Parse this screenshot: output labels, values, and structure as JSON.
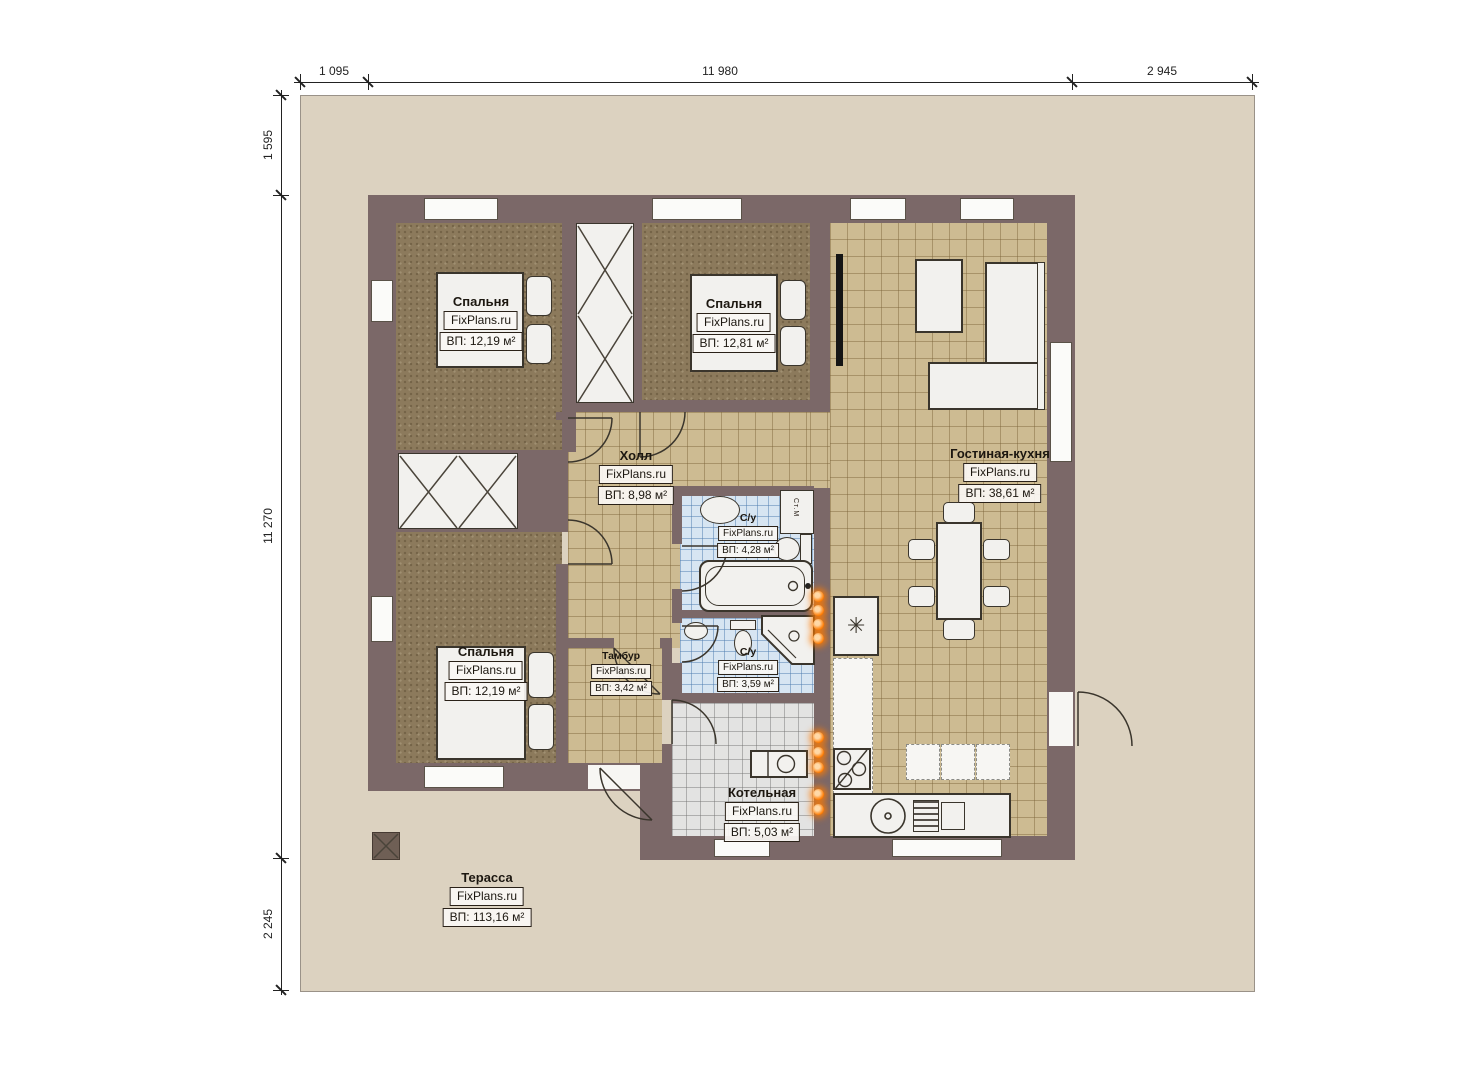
{
  "watermark": "FixPlans.ru",
  "dimensions": {
    "top": [
      "1 095",
      "11 980",
      "2 945"
    ],
    "left": [
      "1 595",
      "11 270",
      "2 245"
    ]
  },
  "rooms": [
    {
      "id": "bedroom-1",
      "name": "Спальня",
      "area": "ВП: 12,19 м²"
    },
    {
      "id": "bedroom-2",
      "name": "Спальня",
      "area": "ВП: 12,81 м²"
    },
    {
      "id": "living-kitchen",
      "name": "Гостиная-кухня",
      "area": "ВП: 38,61 м²"
    },
    {
      "id": "hall",
      "name": "Холл",
      "area": "ВП: 8,98 м²"
    },
    {
      "id": "bathroom-1",
      "name": "С/у",
      "area": "ВП: 4,28 м²"
    },
    {
      "id": "bathroom-2",
      "name": "С/у",
      "area": "ВП: 3,59 м²"
    },
    {
      "id": "vestibule",
      "name": "Тамбур",
      "area": "ВП: 3,42 м²"
    },
    {
      "id": "boiler-room",
      "name": "Котельная",
      "area": "ВП: 5,03 м²"
    },
    {
      "id": "bedroom-3",
      "name": "Спальня",
      "area": "ВП: 12,19 м²"
    },
    {
      "id": "terrace",
      "name": "Терасса",
      "area": "ВП: 113,16 м²"
    }
  ],
  "annotations": {
    "washing_machine": "Ст.М",
    "fridge_symbol": "✳"
  },
  "colors": {
    "wall": "#7b6868",
    "terrace": "#dcd2c0",
    "tile-beige": "#cdbb92",
    "tile-blue": "#d7e5f2",
    "tile-gray": "#e3e3e2",
    "floor-brown": "#8c7a5c",
    "furniture": "#f2f1ee",
    "outline": "#3a352c",
    "heat-orange": "#ff7b00"
  }
}
